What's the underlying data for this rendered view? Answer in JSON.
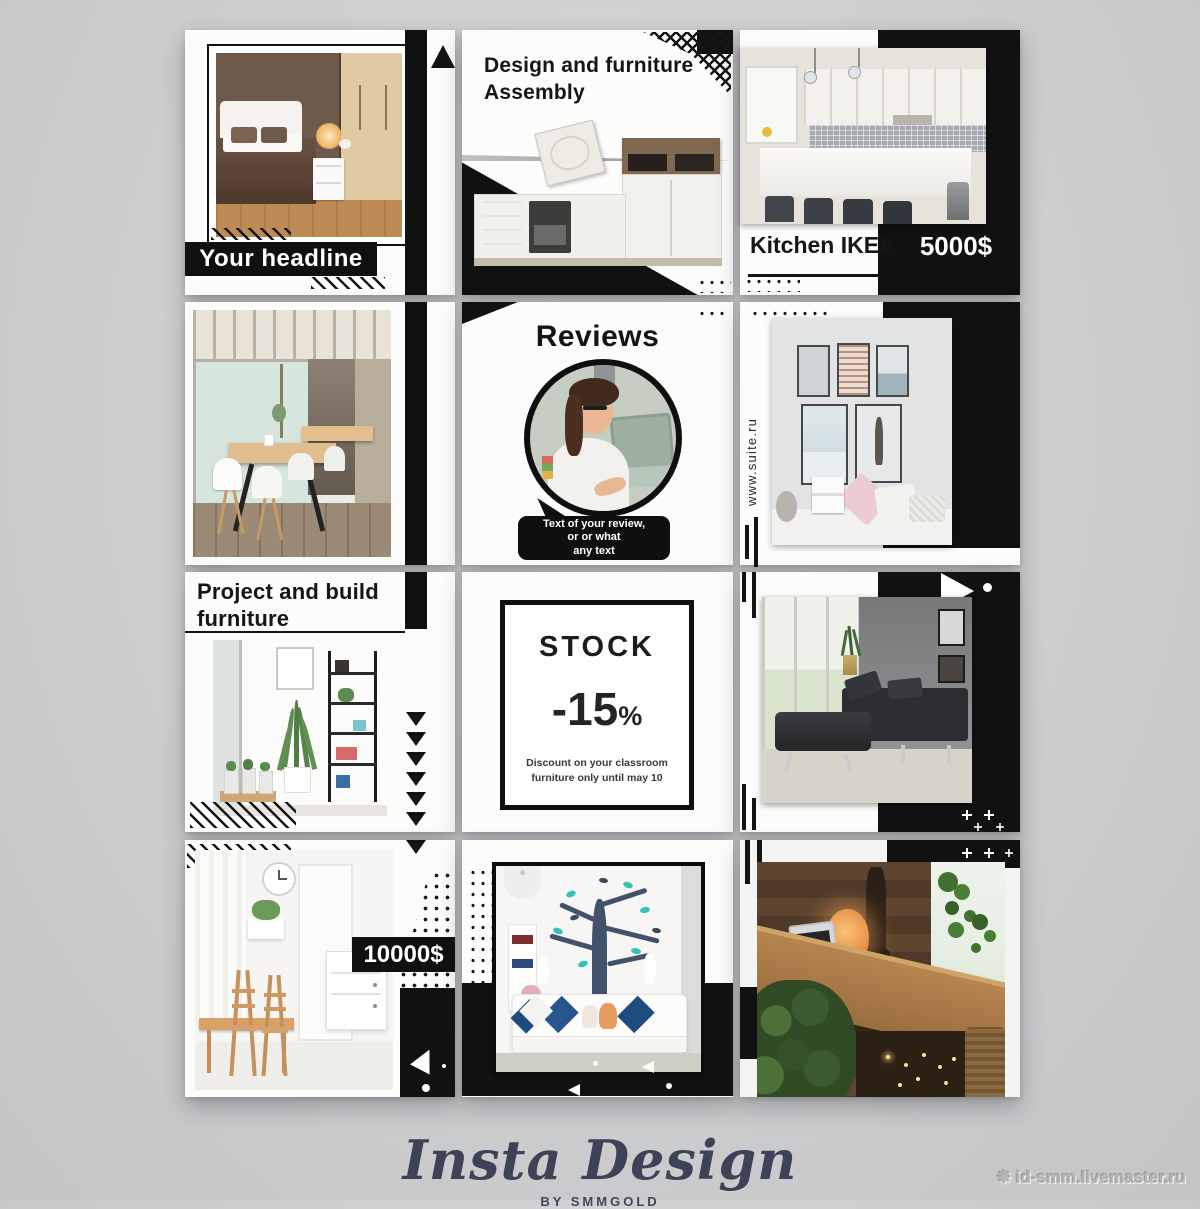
{
  "poster": {
    "row1": {
      "headline_tile": {
        "headline": "Your headline"
      },
      "assembly_tile": {
        "title": [
          "Design and furniture",
          "Assembly"
        ]
      },
      "kitchen_tile": {
        "label": "Kitchen IKEA",
        "price": "5000$"
      }
    },
    "row2": {
      "reviews_tile": {
        "title": "Reviews",
        "bubble": [
          "Text of your review,",
          "or or what",
          "any text"
        ]
      },
      "suite_tile": {
        "url": "www.suite.ru"
      }
    },
    "row3": {
      "project_tile": {
        "title": [
          "Project and build",
          "furniture"
        ]
      },
      "stock_tile": {
        "title": "STOCK",
        "discount": "-15",
        "percent_sign": "%",
        "note": [
          "Discount on your classroom",
          "furniture only until may 10"
        ]
      }
    },
    "row4": {
      "dining_tile": {
        "price": "10000$"
      }
    },
    "colors": {
      "black": "#111111",
      "teal_leaf": "#38c3b2",
      "pillow_blue": "#1f4c7e",
      "navy": "#3c4357"
    }
  },
  "footer": {
    "brand": "Insta Design",
    "byline": "BY SMMGOLD"
  },
  "watermark": {
    "icon_glyph": "❋",
    "text": "id-smm.livemaster.ru"
  }
}
